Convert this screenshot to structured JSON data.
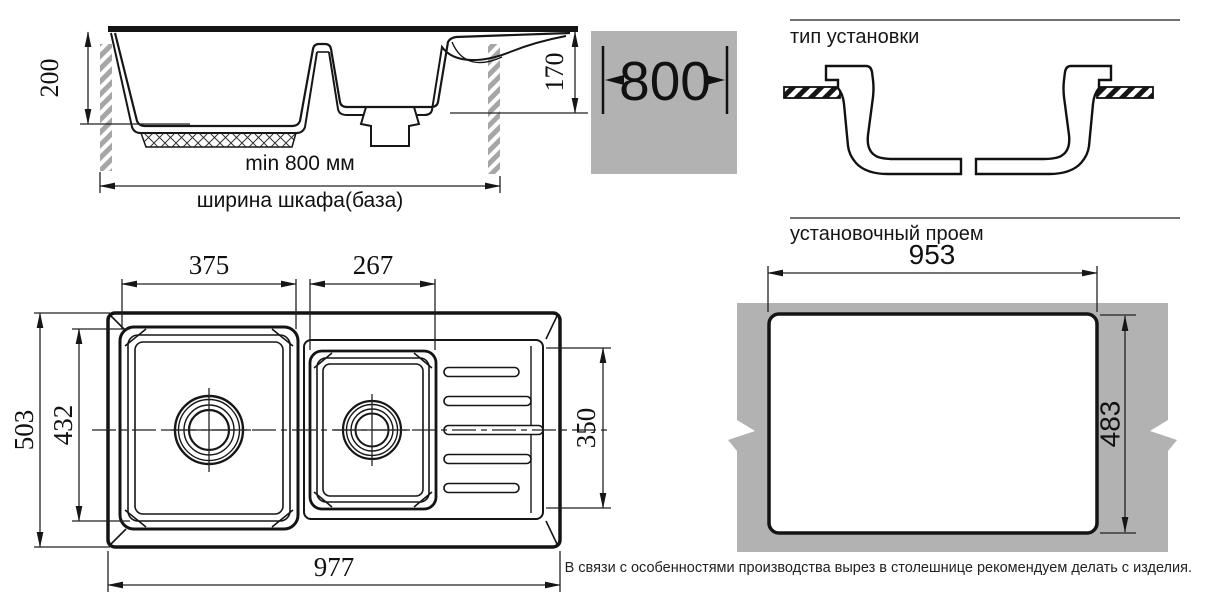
{
  "side_view": {
    "dim_depth": "200",
    "dim_bowl_depth": "170",
    "dim_min_width": "min 800 мм",
    "cabinet_label": "ширина шкафа(база)"
  },
  "badge": {
    "width": "800"
  },
  "installation": {
    "title": "тип установки"
  },
  "opening": {
    "title": "установочный проем",
    "dim_width": "953",
    "dim_height": "483",
    "note": "В связи с особенностями производства вырез в столешнице рекомендуем делать с изделия."
  },
  "top_view": {
    "dim_bowl1": "375",
    "dim_bowl2": "267",
    "dim_depth": "503",
    "dim_bowl_depth": "432",
    "dim_drainer_depth": "350",
    "dim_width": "977"
  },
  "colors": {
    "line": "#161616",
    "countertop_gray": "#b2b2b2"
  }
}
